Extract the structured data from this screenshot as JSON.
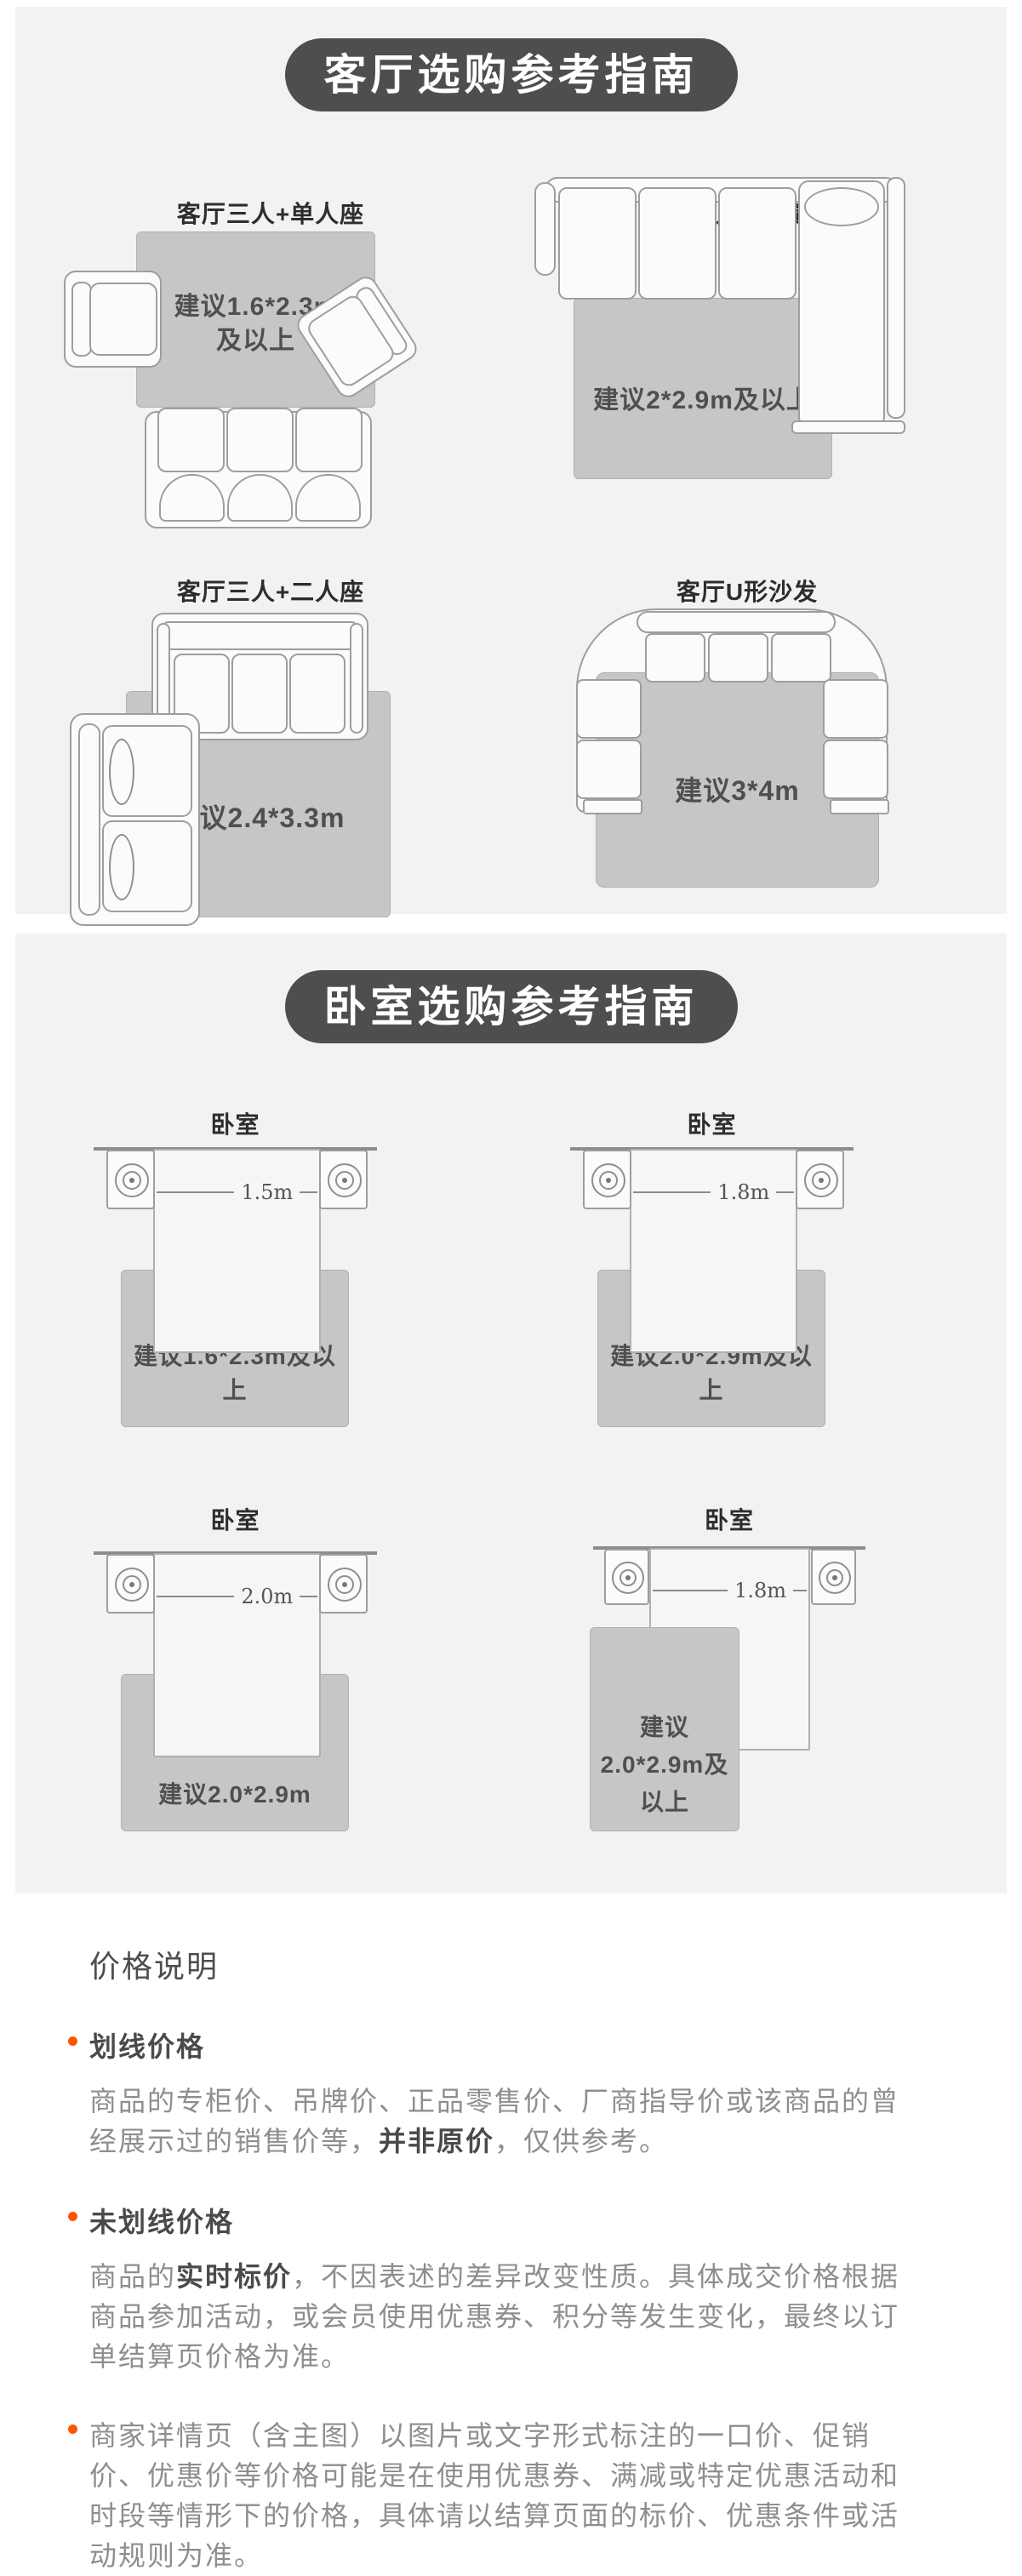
{
  "colors": {
    "card_bg": "#f2f2f2",
    "pill_bg": "#4e4e4e",
    "rug": "#c6c6c6",
    "bullet_accent": "#ff5500"
  },
  "living": {
    "header": "客厅选购参考指南",
    "d1": {
      "title": "客厅三人+单人座",
      "label_line1": "建议1.6*2.3m",
      "label_line2": "及以上"
    },
    "d2": {
      "title": "客厅三人座+贵妃椅",
      "label": "建议2*2.9m及以上"
    },
    "d3": {
      "title": "客厅三人+二人座",
      "label": "建议2.4*3.3m"
    },
    "d4": {
      "title": "客厅U形沙发",
      "label": "建议3*4m"
    }
  },
  "bedroom": {
    "header": "卧室选购参考指南",
    "d1": {
      "title": "卧室",
      "bed_width": "1.5m",
      "label": "建议1.6*2.3m及以上"
    },
    "d2": {
      "title": "卧室",
      "bed_width": "1.8m",
      "label": "建议2.0*2.9m及以上"
    },
    "d3": {
      "title": "卧室",
      "bed_width": "2.0m",
      "label": "建议2.0*2.9m"
    },
    "d4": {
      "title": "卧室",
      "bed_width": "1.8m",
      "label_line1": "建议",
      "label_line2": "2.0*2.9m及以上"
    }
  },
  "price_notes": {
    "title": "价格说明",
    "item1": {
      "subtitle": "划线价格",
      "body_prefix": "商品的专柜价、吊牌价、正品零售价、厂商指导价或该商品的曾经展示过的销售价等，",
      "body_bold": "并非原价",
      "body_suffix": "，仅供参考。"
    },
    "item2": {
      "subtitle": "未划线价格",
      "body_prefix": "商品的",
      "body_bold": "实时标价",
      "body_suffix": "，不因表述的差异改变性质。具体成交价格根据商品参加活动，或会员使用优惠券、积分等发生变化，最终以订单结算页价格为准。"
    },
    "item3": {
      "body": "商家详情页（含主图）以图片或文字形式标注的一口价、促销价、优惠价等价格可能是在使用优惠券、满减或特定优惠活动和时段等情形下的价格，具体请以结算页面的标价、优惠条件或活动规则为准。"
    }
  }
}
